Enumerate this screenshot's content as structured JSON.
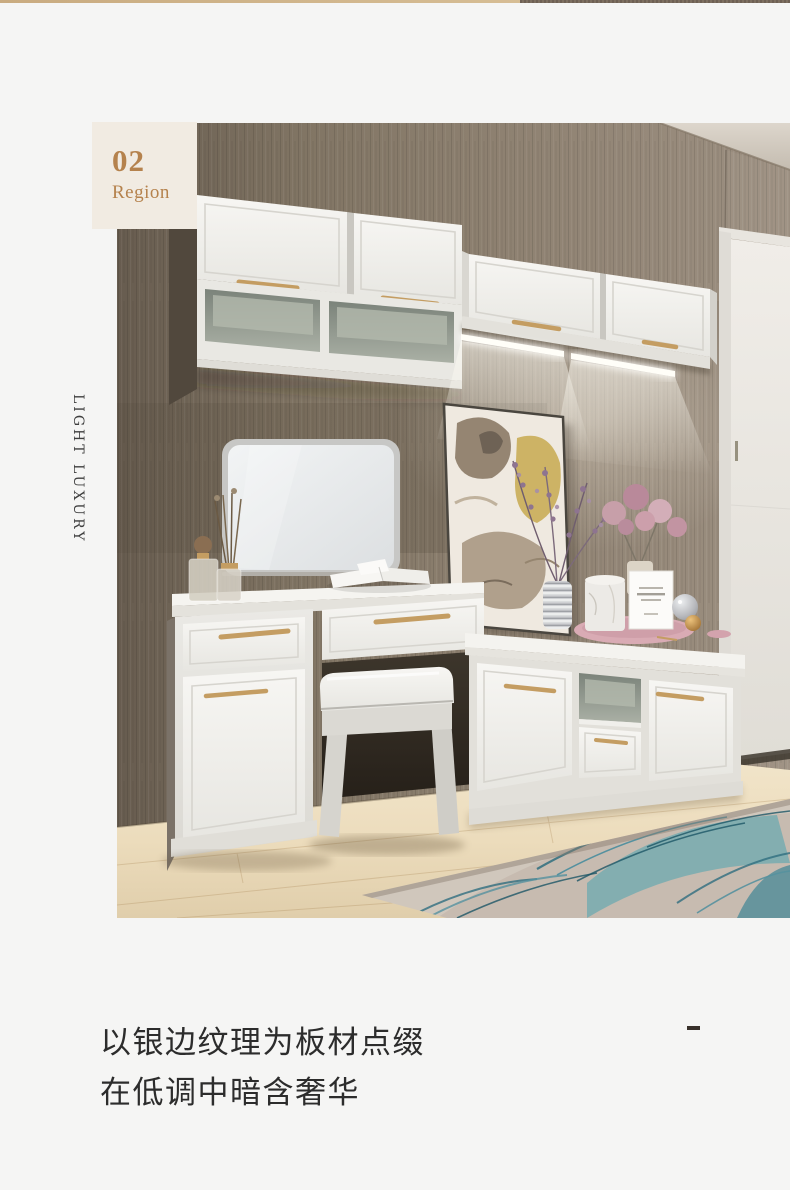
{
  "badge": {
    "number": "02",
    "label": "Region"
  },
  "side_label": {
    "text": "LIGHT LUXURY"
  },
  "caption": {
    "line1": "以银边纹理为板材点缀",
    "line2": "在低调中暗含奢华"
  },
  "colors": {
    "page_bg": "#f5f5f4",
    "badge_bg": "#f1ebe2",
    "accent": "#b5824d",
    "side_color": "#3e3e3e",
    "caption_color": "#2c2c2c",
    "dash_color": "#38302a",
    "strip_left": "#c9ab80",
    "strip_right": "#6e6054",
    "handle_gold": "#c49d62",
    "wall_brown": "#887b6b",
    "cabinet_white": "#efeeea",
    "shelf_interior": "#98a095",
    "floor_wood": "#e9d9ba",
    "rug_teal": "#4b8fa0",
    "door_white": "#eae7e1"
  }
}
